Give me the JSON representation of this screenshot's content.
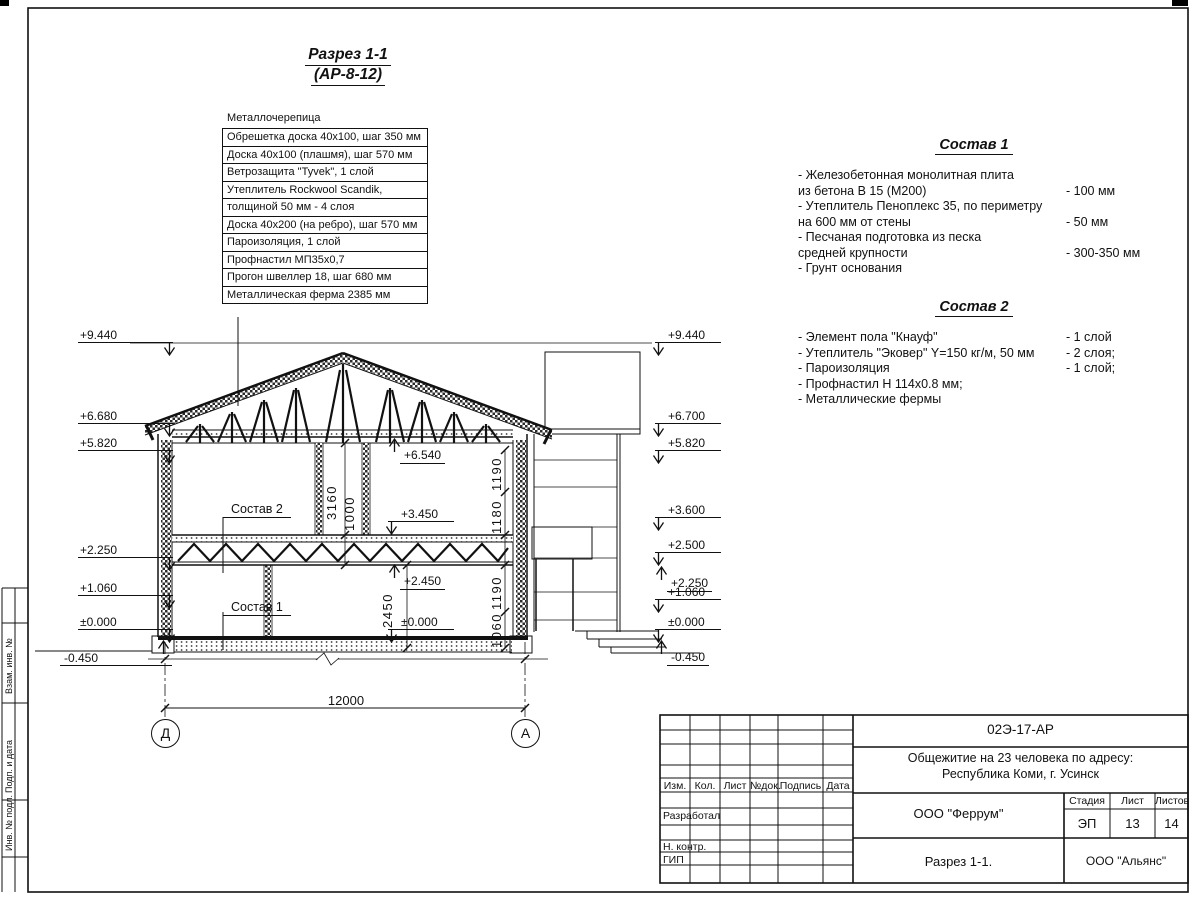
{
  "sheet": {
    "title_line1": "Разрез 1-1",
    "title_line2": "(АР-8-12)"
  },
  "roof_spec": {
    "title": "Металлочерепица",
    "rows": [
      "Обрешетка доска 40х100, шаг 350 мм",
      "Доска 40х100 (плашмя), шаг 570 мм",
      "Ветрозащита \"Tyvek\", 1 слой",
      "Утеплитель Rockwool Scandik,",
      "толщиной 50 мм - 4 слоя",
      "Доска 40х200 (на ребро), шаг 570 мм",
      "Пароизоляция, 1 слой",
      "Профнастил МП35х0,7",
      "Прогон швеллер 18, шаг 680 мм",
      "Металлическая ферма 2385 мм"
    ]
  },
  "sostav1": {
    "title": "Состав 1",
    "items": [
      {
        "text": "- Железобетонная  монолитная плита\n  из бетона В 15 (М200)",
        "value": "- 100 мм"
      },
      {
        "text": "- Утеплитель Пеноплекс 35, по периметру\n  на 600 мм от стены",
        "value": "- 50 мм"
      },
      {
        "text": "- Песчаная подготовка из песка\n  средней крупности",
        "value": "- 300-350 мм"
      },
      {
        "text": "- Грунт основания",
        "value": ""
      }
    ]
  },
  "sostav2": {
    "title": "Состав 2",
    "items": [
      {
        "text": "- Элемент пола \"Кнауф\"",
        "value": "- 1 слой"
      },
      {
        "text": "- Утеплитель \"Эковер\" Y=150 кг/м, 50 мм",
        "value": "- 2 слоя;"
      },
      {
        "text": "- Пароизоляция",
        "value": "- 1 слой;"
      },
      {
        "text": "- Профнастил Н 114х0.8 мм;",
        "value": ""
      },
      {
        "text": "- Металлические фермы",
        "value": ""
      }
    ]
  },
  "levels": [
    {
      "label": "+9.440",
      "x": 78,
      "y": 343,
      "c": "ld"
    },
    {
      "label": "+6.680",
      "x": 78,
      "y": 424,
      "c": "ld"
    },
    {
      "label": "+5.820",
      "x": 78,
      "y": 451,
      "c": "ld"
    },
    {
      "label": "+2.250",
      "x": 78,
      "y": 558,
      "c": "ld"
    },
    {
      "label": "+1.060",
      "x": 78,
      "y": 596,
      "c": "ld"
    },
    {
      "label": "±0.000",
      "x": 78,
      "y": 630,
      "c": "ld"
    },
    {
      "label": "-0.450",
      "x": 60,
      "y": 640,
      "c": "lu"
    },
    {
      "label": "+9.440",
      "x": 655,
      "y": 343,
      "c": "rd"
    },
    {
      "label": "+6.700",
      "x": 655,
      "y": 424,
      "c": "rd"
    },
    {
      "label": "+5.820",
      "x": 655,
      "y": 451,
      "c": "rd"
    },
    {
      "label": "+3.600",
      "x": 655,
      "y": 518,
      "c": "rd"
    },
    {
      "label": "+2.500",
      "x": 655,
      "y": 553,
      "c": "rd"
    },
    {
      "label": "+2.250",
      "x": 655,
      "y": 566,
      "c": "ru"
    },
    {
      "label": "+1.060",
      "x": 655,
      "y": 600,
      "c": "rd"
    },
    {
      "label": "±0.000",
      "x": 655,
      "y": 630,
      "c": "rd"
    },
    {
      "label": "-0.450",
      "x": 655,
      "y": 640,
      "c": "ru"
    },
    {
      "label": "+6.540",
      "x": 388,
      "y": 438,
      "c": "ru"
    },
    {
      "label": "+3.450",
      "x": 388,
      "y": 522,
      "c": "rd"
    },
    {
      "label": "+2.450",
      "x": 388,
      "y": 564,
      "c": "ru"
    },
    {
      "label": "±0.000",
      "x": 388,
      "y": 630,
      "c": "rd"
    }
  ],
  "vdims": [
    {
      "label": "3160",
      "x": 324,
      "y": 520
    },
    {
      "label": "1000",
      "x": 342,
      "y": 531
    },
    {
      "label": "2450",
      "x": 380,
      "y": 628
    },
    {
      "label": "1190",
      "x": 489,
      "y": 491
    },
    {
      "label": "1180",
      "x": 489,
      "y": 534
    },
    {
      "label": "1190",
      "x": 489,
      "y": 610
    },
    {
      "label": "1060",
      "x": 489,
      "y": 648
    }
  ],
  "hdim": {
    "label": "12000"
  },
  "axes": {
    "left": "Д",
    "right": "А"
  },
  "refs": {
    "sostav2": "Состав 2",
    "sostav1": "Состав 1"
  },
  "side_stamp": {
    "labels": [
      {
        "label": "Взам. инв. №",
        "y": 694
      },
      {
        "label": "Подп. и дата",
        "y": 793
      },
      {
        "label": "Инв. № подл.",
        "y": 851
      }
    ]
  },
  "titleblock": {
    "doc_code": "02Э-17-АР",
    "project_line1": "Общежитие на 23 человека по адресу:",
    "project_line2": "Республика Коми, г. Усинск",
    "columns": [
      "Изм.",
      "Кол.",
      "Лист",
      "№док.",
      "Подпись",
      "Дата"
    ],
    "row_developed": "Разработал",
    "row_ncontr": "Н. контр.",
    "row_gip": "ГИП",
    "org": "ООО \"Феррум\"",
    "stage_label": "Стадия",
    "sheet_label": "Лист",
    "sheets_label": "Листов",
    "stage": "ЭП",
    "sheet_no": "13",
    "sheets_total": "14",
    "drawing_name": "Разрез 1-1.",
    "org2": "ООО \"Альянс\""
  }
}
